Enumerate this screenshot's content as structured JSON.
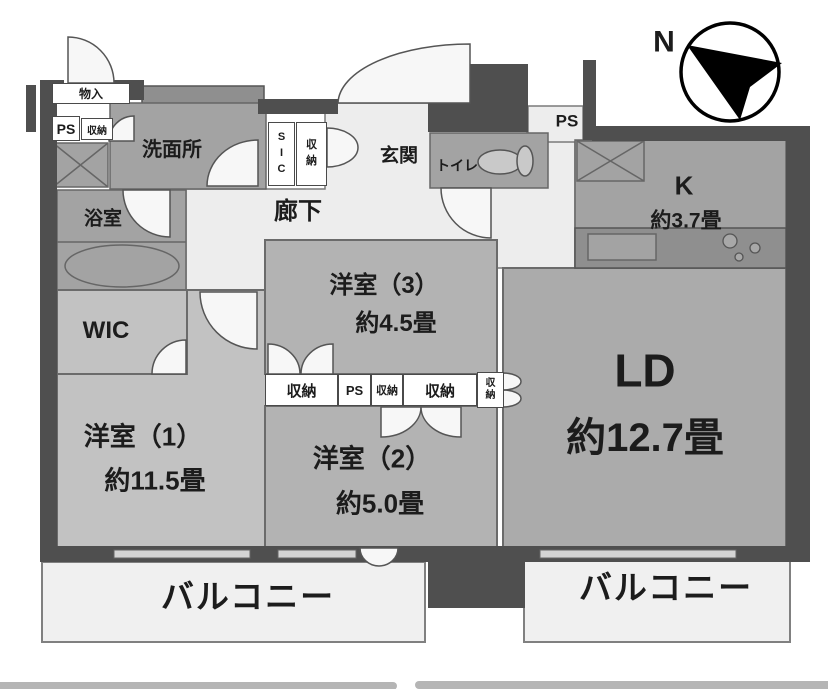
{
  "title": "apartment-floor-plan",
  "colors": {
    "wall": "#4f4f4f",
    "bedroom": "#b3b3b3",
    "bedroom1": "#c2c2c2",
    "living": "#ababab",
    "wet_room": "#a3a3a3",
    "counter": "#8f8f8f",
    "corridor": "#ededed",
    "balcony": "#f0f0f0",
    "bottom_bar": "#b5b5b5"
  },
  "compass": {
    "north_label": "N"
  },
  "labels": {
    "monoiri": "物入",
    "ps_top_left": "PS",
    "shuno_top_left": "収納",
    "senmenjo": "洗面所",
    "sic": "S\nI\nC",
    "shuno_entry": "収\n納",
    "genkan": "玄関",
    "toilet": "トイレ",
    "ps_top_right": "PS",
    "kitchen": "K",
    "kitchen_size": "約3.7畳",
    "rouka": "廊下",
    "yokushitsu": "浴室",
    "wic": "WIC",
    "room3": "洋室（3）",
    "room3_size": "約4.5畳",
    "room1": "洋室（1）",
    "room1_size": "約11.5畳",
    "room2": "洋室（2）",
    "room2_size": "約5.0畳",
    "ld": "LD",
    "ld_size": "約12.7畳",
    "closet_strip": [
      "収納",
      "PS",
      "収納",
      "収納",
      "収\n納"
    ],
    "balcony_left": "バルコニー",
    "balcony_right": "バルコニー"
  }
}
